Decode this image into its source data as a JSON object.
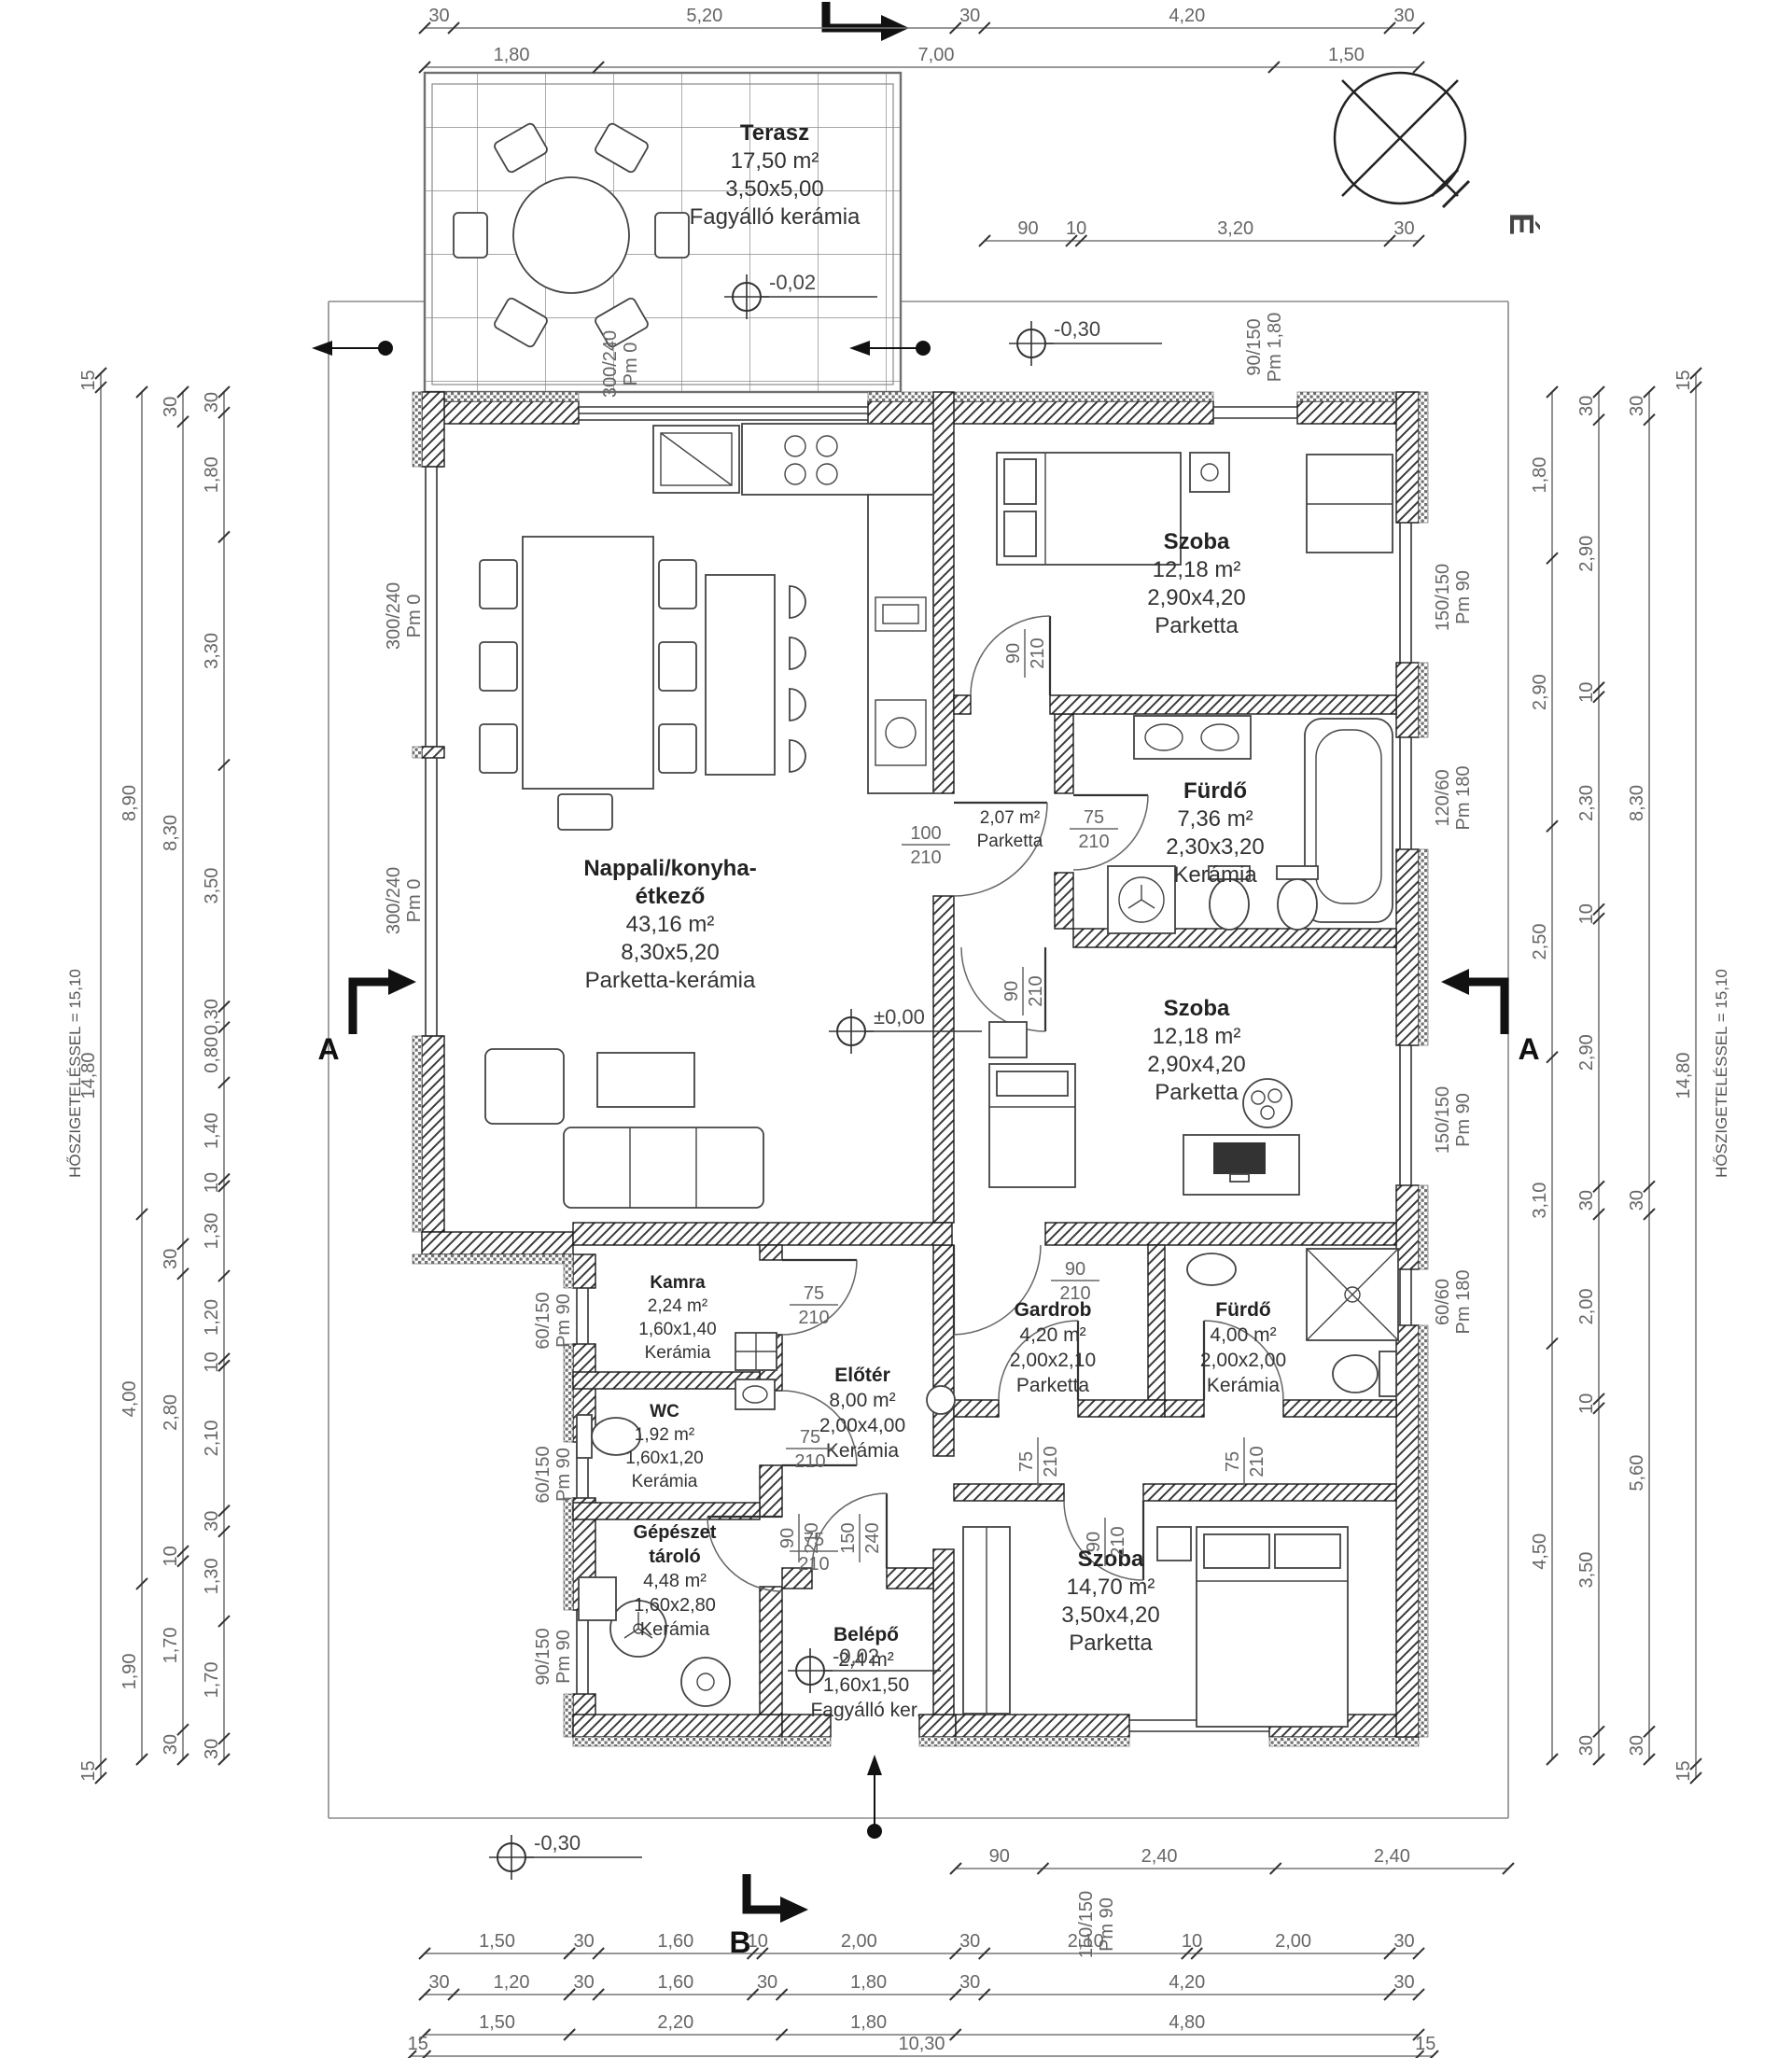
{
  "compass": {
    "label": "É"
  },
  "sections": {
    "a": "A",
    "b": "B"
  },
  "levels": [
    {
      "value": "-0,02"
    },
    {
      "value": "-0,30"
    },
    {
      "value": "±0,00"
    },
    {
      "value": "-0,02"
    },
    {
      "value": "-0,30"
    }
  ],
  "rooms": [
    {
      "name": "Terasz",
      "area": "17,50 m²",
      "size": "3,50x5,00",
      "floor": "Fagyálló kerámia"
    },
    {
      "name": "Nappali/konyha-",
      "name2": "étkező",
      "area": "43,16 m²",
      "size": "8,30x5,20",
      "floor": "Parketta-kerámia"
    },
    {
      "name": "Szoba",
      "area": "12,18 m²",
      "size": "2,90x4,20",
      "floor": "Parketta"
    },
    {
      "name": "Fürdő",
      "area": "7,36 m²",
      "size": "2,30x3,20",
      "floor": "Kerámia"
    },
    {
      "name": "Szoba",
      "area": "12,18 m²",
      "size": "2,90x4,20",
      "floor": "Parketta"
    },
    {
      "name": "Kamra",
      "area": "2,24 m²",
      "size": "1,60x1,40",
      "floor": "Kerámia"
    },
    {
      "name": "WC",
      "area": "1,92 m²",
      "size": "1,60x1,20",
      "floor": "Kerámia"
    },
    {
      "name": "Előtér",
      "area": "8,00 m²",
      "size": "2,00x4,00",
      "floor": "Kerámia"
    },
    {
      "name": "Gardrob",
      "area": "4,20 m²",
      "size": "2,00x2,10",
      "floor": "Parketta"
    },
    {
      "name": "Fürdő",
      "area": "4,00 m²",
      "size": "2,00x2,00",
      "floor": "Kerámia"
    },
    {
      "name": "Gépészet",
      "name2": "tároló",
      "area": "4,48 m²",
      "size": "1,60x2,80",
      "floor": "Kerámia"
    },
    {
      "name": "Belépő",
      "area": "2,4 m²",
      "size": "1,60x1,50",
      "floor": "Fagyálló ker."
    },
    {
      "name": "Szoba",
      "area": "14,70 m²",
      "size": "3,50x4,20",
      "floor": "Parketta"
    },
    {
      "name": "",
      "area": "2,07 m²",
      "size": "",
      "floor": "Parketta"
    }
  ],
  "door_labels": [
    {
      "w": "100",
      "h": "210"
    },
    {
      "w": "75",
      "h": "210"
    },
    {
      "w": "90",
      "h": "210"
    },
    {
      "w": "90",
      "h": "210"
    },
    {
      "w": "90",
      "h": "210"
    },
    {
      "w": "75",
      "h": "210"
    },
    {
      "w": "75",
      "h": "210"
    },
    {
      "w": "75",
      "h": "210"
    },
    {
      "w": "75",
      "h": "210"
    },
    {
      "w": "75",
      "h": "210"
    },
    {
      "w": "90",
      "h": "210"
    },
    {
      "w": "150",
      "h": "240"
    },
    {
      "w": "90",
      "h": "210"
    }
  ],
  "windows": [
    {
      "size": "300/240",
      "pm": "Pm 0"
    },
    {
      "size": "300/240",
      "pm": "Pm 0"
    },
    {
      "size": "300/240",
      "pm": "Pm 0"
    },
    {
      "size": "60/150",
      "pm": "Pm 90"
    },
    {
      "size": "60/150",
      "pm": "Pm 90"
    },
    {
      "size": "90/150",
      "pm": "Pm 90"
    },
    {
      "size": "90/150",
      "pm": "Pm 1,80"
    },
    {
      "size": "150/150",
      "pm": "Pm 90"
    },
    {
      "size": "120/60",
      "pm": "Pm 180"
    },
    {
      "size": "150/150",
      "pm": "Pm 90"
    },
    {
      "size": "60/60",
      "pm": "Pm 180"
    },
    {
      "size": "150/150",
      "pm": "Pm 90"
    }
  ],
  "dims": {
    "top1": [
      "30",
      "5,20",
      "30",
      "4,20",
      "30"
    ],
    "top2": [
      "1,80",
      "7,00",
      "1,50"
    ],
    "top3": [
      "90",
      "10",
      "3,20",
      "30"
    ],
    "bottom1": [
      "90",
      "2,40",
      "2,40"
    ],
    "bottom2": [
      "1,50",
      "30",
      "1,60",
      "10",
      "2,00",
      "30",
      "2,10",
      "10",
      "2,00",
      "30"
    ],
    "bottom3": [
      "30",
      "1,20",
      "30",
      "1,60",
      "30",
      "1,80",
      "30",
      "4,20",
      "30"
    ],
    "bottom4": [
      "1,50",
      "2,20",
      "1,80",
      "4,80"
    ],
    "bottom5": [
      "15",
      "10,30",
      "15"
    ],
    "left1": [
      "30",
      "1,80",
      "3,30",
      "3,50",
      "0,30",
      "0,80",
      "1,40",
      "10",
      "1,30",
      "1,20",
      "10",
      "2,10",
      "30",
      "1,30",
      "1,70",
      "30"
    ],
    "left2": [
      "30",
      "8,30",
      "30",
      "2,80",
      "10",
      "1,70",
      "30"
    ],
    "left3": [
      "8,90",
      "4,00",
      "1,90"
    ],
    "left4": [
      "15",
      "14,80",
      "15"
    ],
    "right1": [
      "1,80",
      "2,90",
      "2,50",
      "3,10",
      "4,50"
    ],
    "right2": [
      "30",
      "2,90",
      "10",
      "2,30",
      "10",
      "2,90",
      "30",
      "2,00",
      "10",
      "3,50",
      "30"
    ],
    "right3": [
      "30",
      "8,30",
      "30",
      "5,60",
      "30"
    ],
    "right4": [
      "15",
      "14,80",
      "15"
    ],
    "left_note": "HŐSZIGETELÉSSEL = 15,10",
    "right_note": "HŐSZIGETELÉSSEL = 15,10"
  }
}
